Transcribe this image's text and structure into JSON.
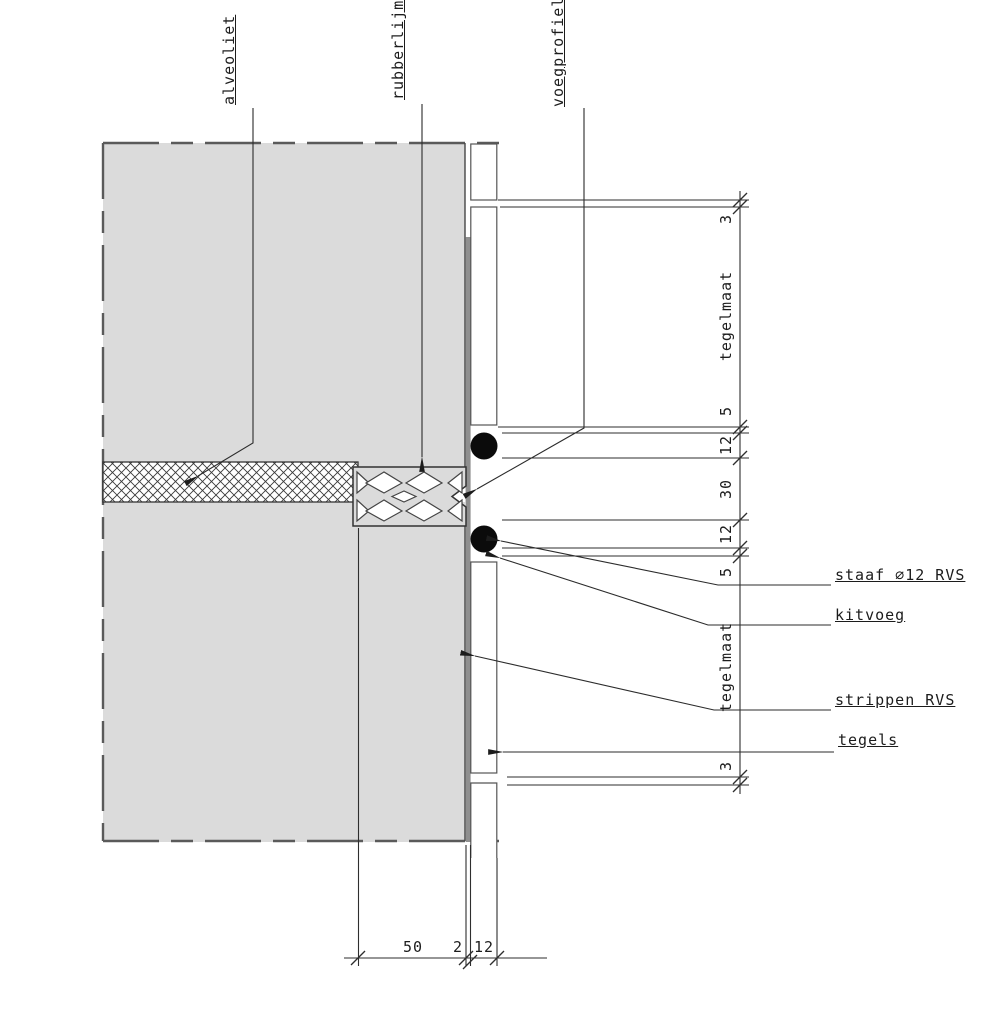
{
  "diagram": {
    "type": "construction-detail-section",
    "callouts_top": [
      {
        "id": "alveoliet",
        "text": "alveoliet"
      },
      {
        "id": "rubberlijm",
        "text": "rubberlijm"
      },
      {
        "id": "voegprofiel",
        "text": "voegprofiel"
      }
    ],
    "callouts_right": [
      {
        "id": "staaf",
        "text": "staaf ⌀12 RVS"
      },
      {
        "id": "kitvoeg",
        "text": "kitvoeg"
      },
      {
        "id": "strippen",
        "text": "strippen RVS"
      },
      {
        "id": "tegels",
        "text": "tegels"
      }
    ],
    "dimensions_right": [
      {
        "value": "3"
      },
      {
        "value": "tegelmaat"
      },
      {
        "value": "5"
      },
      {
        "value": "12"
      },
      {
        "value": "30"
      },
      {
        "value": "12"
      },
      {
        "value": "5"
      },
      {
        "value": "tegelmaat"
      },
      {
        "value": "3"
      }
    ],
    "dimensions_bottom": [
      {
        "value": "50"
      },
      {
        "value": "2"
      },
      {
        "value": "12"
      }
    ],
    "colors": {
      "wall_fill": "#dbdbdb",
      "line": "#3a3a3a",
      "strip_fill": "#8f8f8f",
      "rod_fill": "#0b0b0b",
      "background": "#ffffff"
    }
  }
}
